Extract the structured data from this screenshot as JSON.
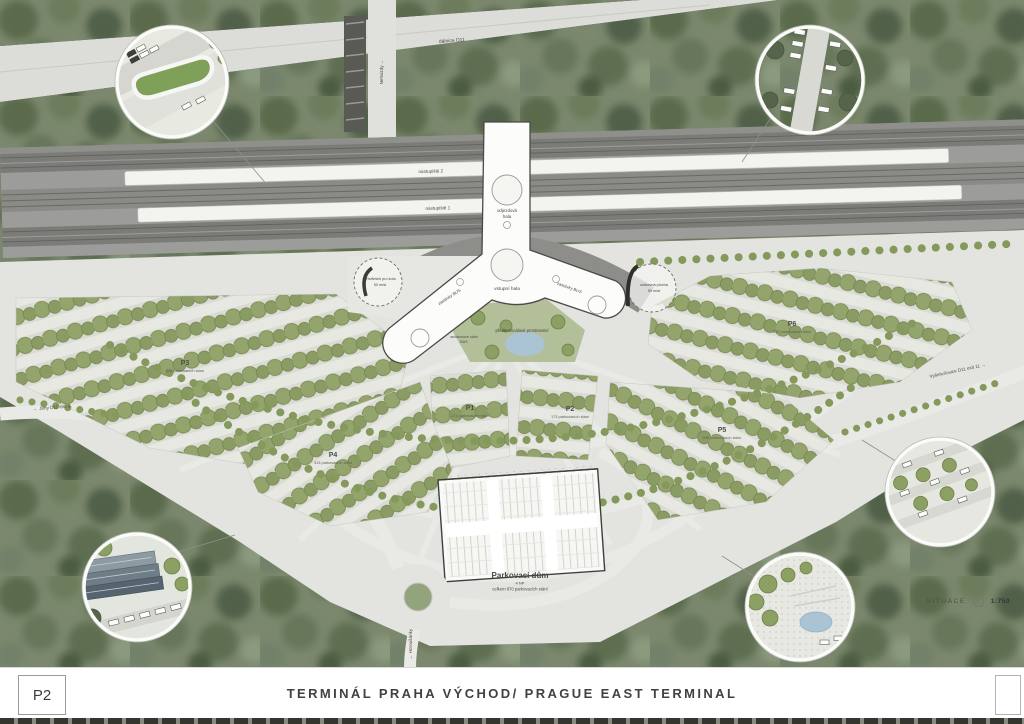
{
  "title_bar": {
    "sheet_number": "P2",
    "title": "TERMINÁL PRAHA VÝCHOD/ PRAGUE EAST TERMINAL"
  },
  "legend": {
    "type_label": "SITUACE",
    "scale": "1:750"
  },
  "plan": {
    "roads": {
      "highway": "dálnice D11",
      "north": "Nehvizdy →",
      "west": "← Jirny D11 exit 8",
      "east": "Vyšehořovice D11 exit 11 →",
      "south": "← Horoušánky"
    },
    "railway": {
      "platform_2": "nástupiště 2",
      "platform_1": "nástupiště 1"
    },
    "terminal": {
      "entrance_hall": "vstupní hala",
      "departure_hall_line1": "odjezdová",
      "departure_hall_line2": "hala",
      "left_wing": "zastávky BUS",
      "right_wing": "zastávky BUS",
      "bus_bay_line1": "autobusové stání",
      "bus_bay_line2": "BUS",
      "bike_shelter_line1": "přístřešek pro kola",
      "bike_shelter_line2": "50 míst",
      "layover_line1": "odstavná plocha",
      "layover_line2": "50 míst",
      "forecourt": "předterminálové prostranství"
    },
    "parking_lots": [
      {
        "id": "P1",
        "capacity": "171 parkovacích stání"
      },
      {
        "id": "P2",
        "capacity": "173 parkovacích stání"
      },
      {
        "id": "P3",
        "capacity": "628 parkovacích stání"
      },
      {
        "id": "P4",
        "capacity": "313 parkovacích stání"
      },
      {
        "id": "P5",
        "capacity": "538 parkovacích stání"
      },
      {
        "id": "P6",
        "capacity": "639 parkovacích stání"
      }
    ],
    "parking_house": {
      "name": "Parkovací dům",
      "floors": "4 NP",
      "total": "celkem 870 parkovacích stání"
    }
  },
  "colors": {
    "forest_green": "#7b886d",
    "tree_green": "#8ca064",
    "road_gray": "#e3e3df",
    "rail_gray": "#9c9c9a",
    "building_white": "#fcfcfa",
    "pond_blue": "#aac4d4"
  }
}
